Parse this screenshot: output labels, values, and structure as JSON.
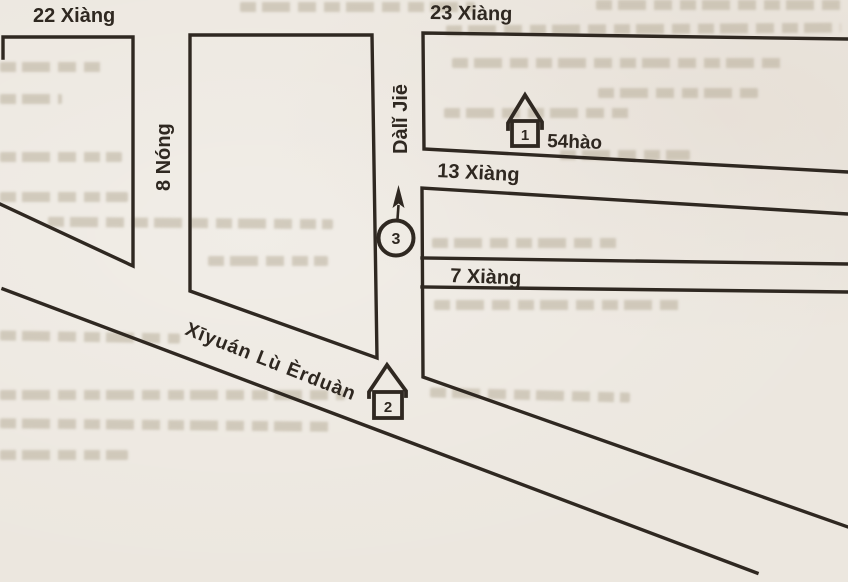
{
  "map": {
    "title_hint": "hand-drawn street map (scanned textbook figure)",
    "colors": {
      "ink": "#2f2821",
      "paper": "#ece7df"
    },
    "streets": {
      "xiang22": "22 Xiàng",
      "xiang23": "23 Xiàng",
      "nong8": "8 Nóng",
      "dali_jie": "Dàlǐ Jiē",
      "xiang13": "13 Xiàng",
      "xiang7": "7 Xiàng",
      "xiyuan_lu_erduan": "Xīyuán Lù Èrduàn"
    },
    "markers": {
      "house1": {
        "number": "1",
        "address": "54hào"
      },
      "house2": {
        "number": "2"
      },
      "point3": {
        "number": "3"
      }
    }
  }
}
